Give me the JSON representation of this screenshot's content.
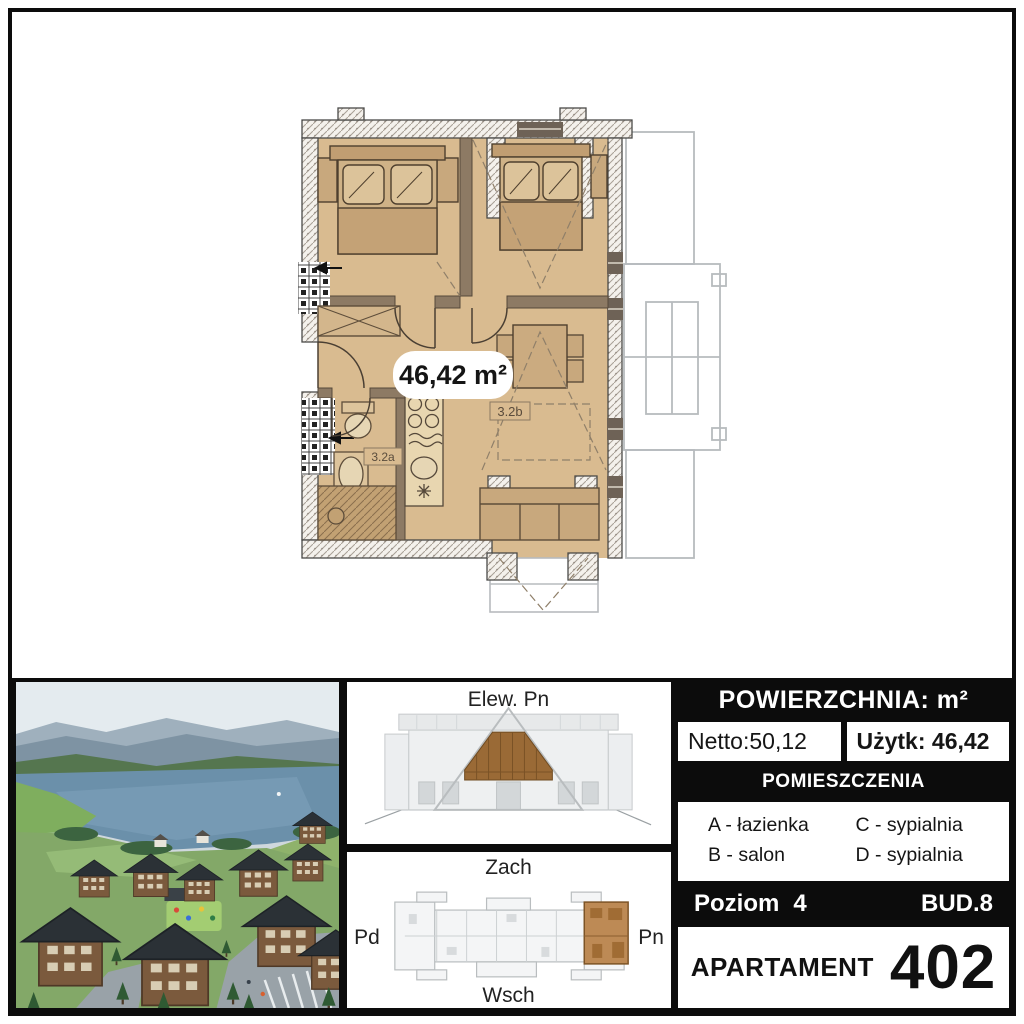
{
  "floor_plan": {
    "area_label": "46,42 m²",
    "bathroom_label": "3.2a",
    "living_label": "3.2b"
  },
  "elevation_panel": {
    "title": "Elew. Pn"
  },
  "keyplan_panel": {
    "top": "Zach",
    "bottom": "Wsch",
    "left": "Pd",
    "right": "Pn"
  },
  "info_panel": {
    "header": "POWIERZCHNIA: m²",
    "netto": "Netto:50,12",
    "uzytk": "Użytk: 46,42",
    "rooms_header": "POMIESZCZENIA",
    "legend": [
      "A - łazienka",
      "B - salon",
      "C - sypialnia",
      "D - sypialnia"
    ],
    "level_label": "Poziom",
    "level_value": "4",
    "building": "BUD.8",
    "apartment_label": "APARTAMENT",
    "apartment_number": "402"
  },
  "colors": {
    "floor_tan": "#d9bb90",
    "highlight_brown": "#9a6a36",
    "panel_black": "#0c0c0c"
  }
}
